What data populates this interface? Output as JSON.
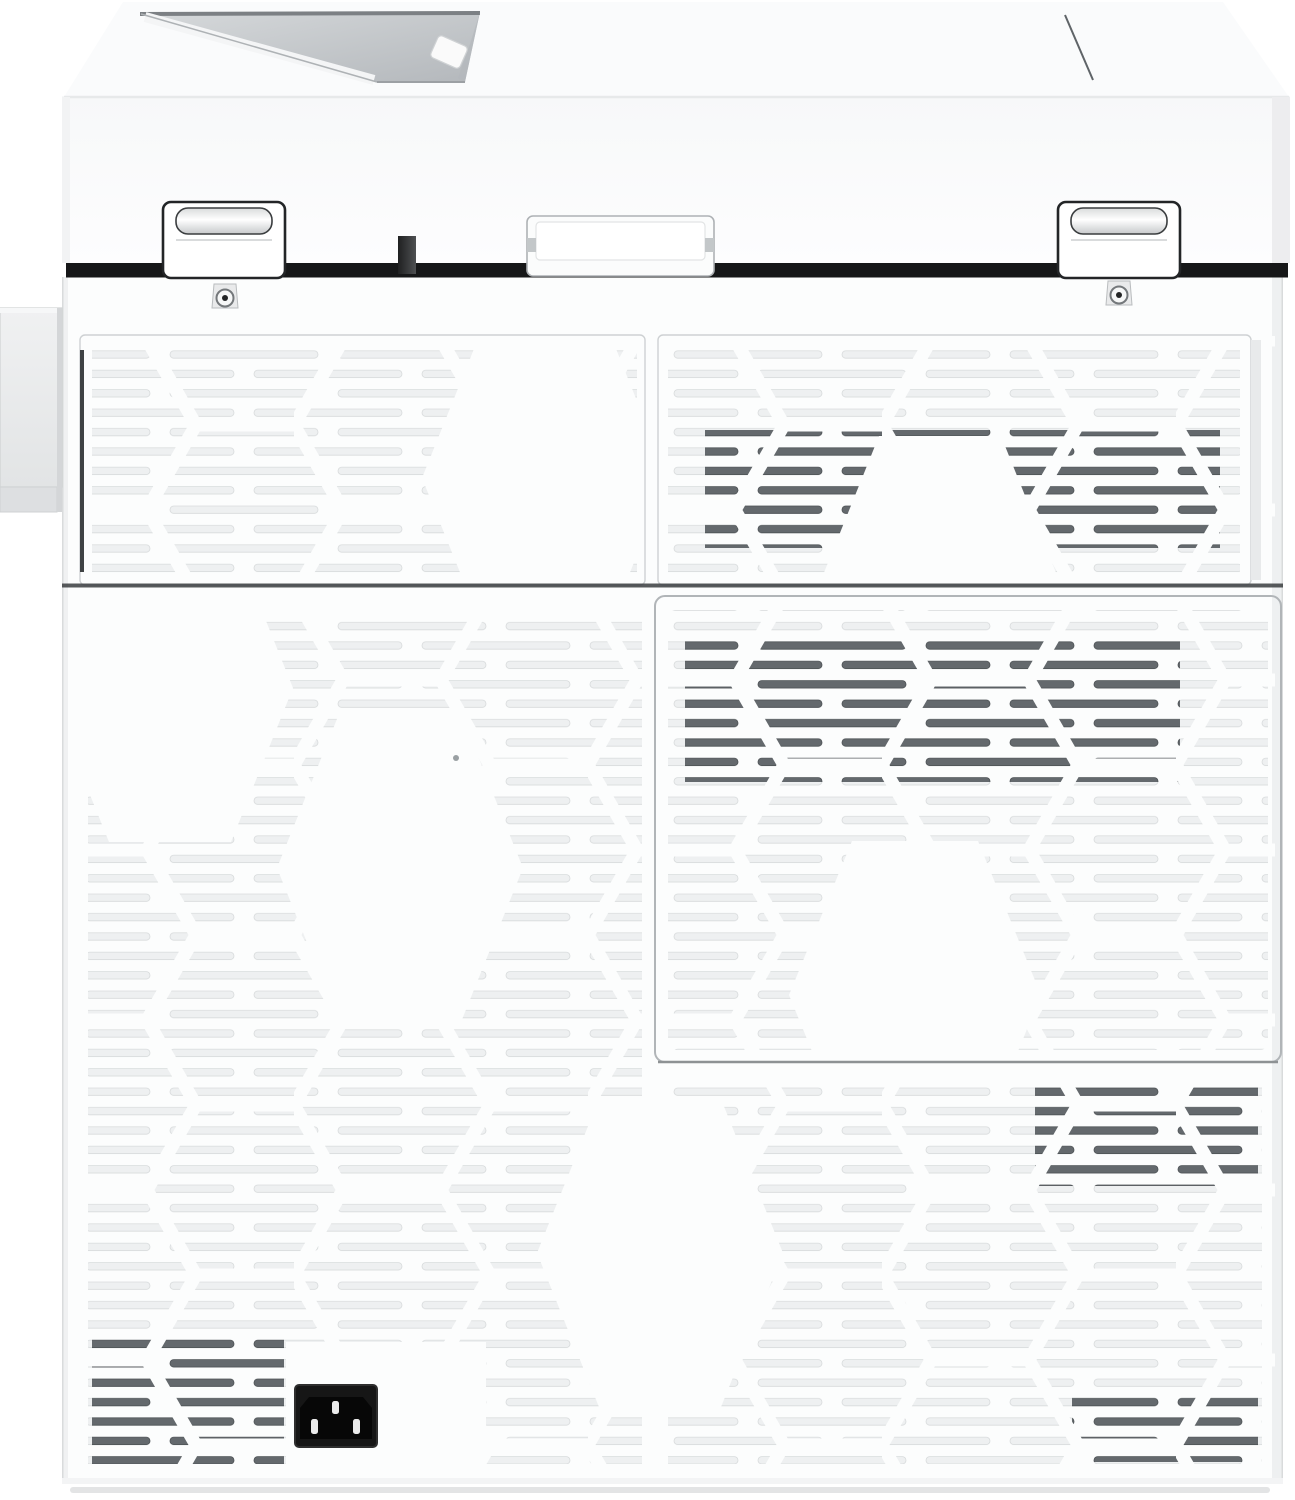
{
  "meta": {
    "subject": "rear view of a white multifunction laser printer",
    "visible_text": "none"
  },
  "colors": {
    "bg": "#ffffff",
    "body_panel": "#fcfdfd",
    "top_surface": "#fafbfc",
    "front_face_top": "#f7f8f9",
    "front_face_bottom": "#fdfdfe",
    "edge_light": "#e7e9ea",
    "slot_light": "#eef0f1",
    "slot_light_border": "#d8dbdc",
    "slot_dark": "#64696d",
    "slot_dark_border": "#4e5356",
    "recess_gray": "#ccd0d3",
    "recess_deep": "#b4b8bc",
    "recess_edge_dark": "#7c8084",
    "gap_band_dark": "#161718",
    "hinge_outline": "#232527",
    "hinge_pill": "#e3e5e6",
    "latch_border": "#aeb2b5",
    "panel_border": "#ced1d3",
    "door_border": "#b1b5b8",
    "door_bottom_line": "#8e9294",
    "seam_dark": "#3a3d3f",
    "left_accent": "#3f4244",
    "handle_gray": "#ebeced",
    "handle_border": "#cfd2d3",
    "handle_lip": "#dddfe1",
    "screw_plate": "#e9eaeb",
    "screw_ring": "#74787b",
    "screw_dot": "#232425",
    "socket_bezel": "#161616",
    "socket_inner": "#070707",
    "socket_pin": "#ebebeb",
    "post_dark": "#1f2021",
    "post_light": "#4e5052",
    "ground_shadow": "#e0e1e2"
  },
  "parts": [
    "top-cover",
    "output-tray-recess",
    "paper-stop-tab",
    "top-seam-line",
    "hinge-left",
    "hinge-right",
    "center-latch",
    "lock-post",
    "rear-body",
    "screw-left",
    "screw-right",
    "upper-vent-panel-left",
    "upper-vent-panel-right",
    "rear-door-panel",
    "bottom-vent-area",
    "side-handle",
    "power-inlet",
    "ground-shadow"
  ]
}
